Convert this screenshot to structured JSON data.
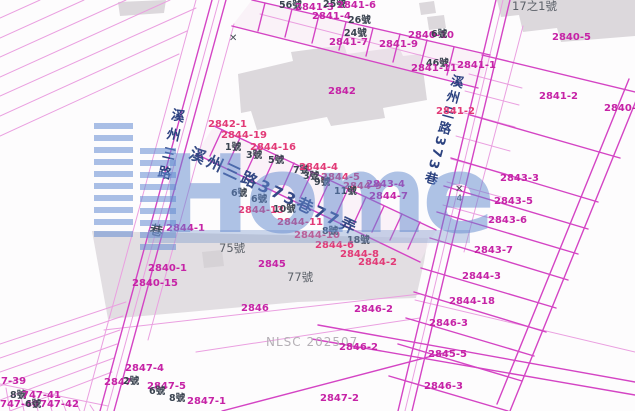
{
  "map": {
    "attribution": "NLSC 202507",
    "watermark": {
      "text": "Home"
    },
    "roads": {
      "left": "溪州三路",
      "left_alley": "巷",
      "center": "溪州三路373巷77弄",
      "right": "溪州三路373巷"
    },
    "control_points": [
      {
        "symbol": "✕",
        "label": "4",
        "x": 455,
        "y": 185
      },
      {
        "symbol": "✕",
        "label": "",
        "x": 229,
        "y": 34
      }
    ],
    "colors": {
      "parcel_line": "#d444c4",
      "parcel_line_light": "#ea9fe0",
      "parcel_label": "#c623a6",
      "parcel_label_alt": "#e23a77",
      "house_label": "#39424f",
      "road_label": "#2c4280",
      "building_fill": "#dcd8dc",
      "watermark_blue": "#6f9ad2"
    },
    "labels": [
      {
        "t": "56號",
        "x": 279,
        "y": 1,
        "k": "h"
      },
      {
        "t": "2841-3",
        "x": 295,
        "y": 3,
        "k": "p"
      },
      {
        "t": "25號",
        "x": 323,
        "y": 0,
        "k": "h"
      },
      {
        "t": "2841-6",
        "x": 337,
        "y": 1,
        "k": "p"
      },
      {
        "t": "2841-4",
        "x": 312,
        "y": 12,
        "k": "p"
      },
      {
        "t": "26號",
        "x": 348,
        "y": 16,
        "k": "h"
      },
      {
        "t": "24號",
        "x": 344,
        "y": 29,
        "k": "h"
      },
      {
        "t": "2841-7",
        "x": 329,
        "y": 38,
        "k": "p"
      },
      {
        "t": "2841-9",
        "x": 379,
        "y": 40,
        "k": "p"
      },
      {
        "t": "2840-10",
        "x": 408,
        "y": 31,
        "k": "p"
      },
      {
        "t": "6號",
        "x": 431,
        "y": 30,
        "k": "h"
      },
      {
        "t": "46號",
        "x": 426,
        "y": 59,
        "k": "h"
      },
      {
        "t": "2841-11",
        "x": 411,
        "y": 64,
        "k": "p"
      },
      {
        "t": "2841-1",
        "x": 457,
        "y": 61,
        "k": "p"
      },
      {
        "t": "17之1號",
        "x": 512,
        "y": 1,
        "k": "g"
      },
      {
        "t": "2840-5",
        "x": 552,
        "y": 33,
        "k": "p"
      },
      {
        "t": "2841-2",
        "x": 539,
        "y": 92,
        "k": "p"
      },
      {
        "t": "2840-1",
        "x": 604,
        "y": 104,
        "k": "p"
      },
      {
        "t": "2842",
        "x": 328,
        "y": 87,
        "k": "p"
      },
      {
        "t": "2841-2",
        "x": 436,
        "y": 107,
        "k": "r"
      },
      {
        "t": "2842-1",
        "x": 208,
        "y": 120,
        "k": "r"
      },
      {
        "t": "2844-19",
        "x": 221,
        "y": 131,
        "k": "r"
      },
      {
        "t": "2844-16",
        "x": 250,
        "y": 143,
        "k": "r"
      },
      {
        "t": "1號",
        "x": 225,
        "y": 143,
        "k": "h"
      },
      {
        "t": "3號",
        "x": 246,
        "y": 151,
        "k": "h"
      },
      {
        "t": "5號",
        "x": 268,
        "y": 156,
        "k": "h"
      },
      {
        "t": "7號",
        "x": 293,
        "y": 166,
        "k": "h"
      },
      {
        "t": "2844-4",
        "x": 299,
        "y": 163,
        "k": "r"
      },
      {
        "t": "3號",
        "x": 303,
        "y": 172,
        "k": "h"
      },
      {
        "t": "2844-5",
        "x": 321,
        "y": 173,
        "k": "r"
      },
      {
        "t": "9號",
        "x": 314,
        "y": 178,
        "k": "h"
      },
      {
        "t": "2844-9",
        "x": 343,
        "y": 182,
        "k": "r"
      },
      {
        "t": "11號",
        "x": 334,
        "y": 187,
        "k": "h"
      },
      {
        "t": "2843-4",
        "x": 366,
        "y": 180,
        "k": "p"
      },
      {
        "t": "2844-7",
        "x": 369,
        "y": 192,
        "k": "p"
      },
      {
        "t": "6號",
        "x": 231,
        "y": 189,
        "k": "h"
      },
      {
        "t": "6號",
        "x": 251,
        "y": 195,
        "k": "h"
      },
      {
        "t": "2844-13",
        "x": 238,
        "y": 206,
        "k": "r"
      },
      {
        "t": "10號",
        "x": 273,
        "y": 205,
        "k": "h"
      },
      {
        "t": "2844-11",
        "x": 277,
        "y": 218,
        "k": "r"
      },
      {
        "t": "2844-10",
        "x": 294,
        "y": 231,
        "k": "r"
      },
      {
        "t": "8號",
        "x": 322,
        "y": 227,
        "k": "h"
      },
      {
        "t": "18號",
        "x": 347,
        "y": 236,
        "k": "h"
      },
      {
        "t": "2844-6",
        "x": 315,
        "y": 241,
        "k": "r"
      },
      {
        "t": "2844-8",
        "x": 340,
        "y": 250,
        "k": "r"
      },
      {
        "t": "2844-2",
        "x": 358,
        "y": 258,
        "k": "r"
      },
      {
        "t": "2844-1",
        "x": 166,
        "y": 224,
        "k": "p"
      },
      {
        "t": "75號",
        "x": 219,
        "y": 243,
        "k": "g"
      },
      {
        "t": "2845",
        "x": 258,
        "y": 260,
        "k": "p"
      },
      {
        "t": "2840-1",
        "x": 148,
        "y": 264,
        "k": "p"
      },
      {
        "t": "2840-15",
        "x": 132,
        "y": 279,
        "k": "p"
      },
      {
        "t": "77號",
        "x": 287,
        "y": 272,
        "k": "g"
      },
      {
        "t": "2846",
        "x": 241,
        "y": 304,
        "k": "p"
      },
      {
        "t": "2846-2",
        "x": 354,
        "y": 305,
        "k": "p"
      },
      {
        "t": "2846-2",
        "x": 339,
        "y": 343,
        "k": "p"
      },
      {
        "t": "2843-3",
        "x": 500,
        "y": 174,
        "k": "p"
      },
      {
        "t": "2843-5",
        "x": 494,
        "y": 197,
        "k": "p"
      },
      {
        "t": "2843-6",
        "x": 488,
        "y": 216,
        "k": "p"
      },
      {
        "t": "2843-7",
        "x": 474,
        "y": 246,
        "k": "p"
      },
      {
        "t": "2844-3",
        "x": 462,
        "y": 272,
        "k": "p"
      },
      {
        "t": "2844-18",
        "x": 449,
        "y": 297,
        "k": "p"
      },
      {
        "t": "2846-3",
        "x": 429,
        "y": 319,
        "k": "p"
      },
      {
        "t": "2845-5",
        "x": 428,
        "y": 350,
        "k": "p"
      },
      {
        "t": "2846-3",
        "x": 424,
        "y": 382,
        "k": "p"
      },
      {
        "t": "2847-2",
        "x": 320,
        "y": 394,
        "k": "p"
      },
      {
        "t": "2847-4",
        "x": 125,
        "y": 364,
        "k": "p"
      },
      {
        "t": "2847",
        "x": 104,
        "y": 378,
        "k": "p"
      },
      {
        "t": "2號",
        "x": 123,
        "y": 377,
        "k": "h"
      },
      {
        "t": "2847-5",
        "x": 147,
        "y": 382,
        "k": "p"
      },
      {
        "t": "6號",
        "x": 149,
        "y": 387,
        "k": "h"
      },
      {
        "t": "8號",
        "x": 169,
        "y": 394,
        "k": "h"
      },
      {
        "t": "2847-1",
        "x": 187,
        "y": 397,
        "k": "p"
      },
      {
        "t": "7-39",
        "x": 1,
        "y": 377,
        "k": "p"
      },
      {
        "t": "8號",
        "x": 10,
        "y": 391,
        "k": "h"
      },
      {
        "t": "747-41",
        "x": 22,
        "y": 391,
        "k": "p"
      },
      {
        "t": "747-40",
        "x": 0,
        "y": 400,
        "k": "p"
      },
      {
        "t": "6號",
        "x": 25,
        "y": 400,
        "k": "h"
      },
      {
        "t": "747-42",
        "x": 40,
        "y": 400,
        "k": "p"
      }
    ]
  }
}
